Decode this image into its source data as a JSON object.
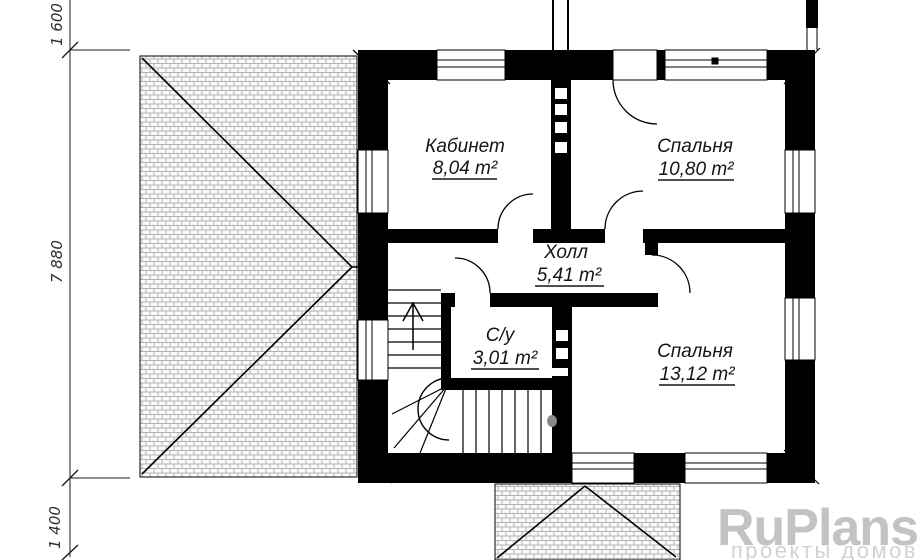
{
  "plan": {
    "rooms": [
      {
        "label": "Кабинет",
        "area": "8,04 m²"
      },
      {
        "label": "Спальня",
        "area": "10,80 m²"
      },
      {
        "label": "Холл",
        "area": "5,41 m²"
      },
      {
        "label": "С/у",
        "area": "3,01 m²"
      },
      {
        "label": "Спальня",
        "area": "13,12 m²"
      }
    ],
    "dimensions": {
      "top": "1 600",
      "middle": "7 880",
      "bottom": "1 400"
    }
  },
  "watermark": {
    "brand": "RuPlans",
    "tagline": "проекты домов",
    "brand_color": "#c3c3c3",
    "tagline_color": "#d2d2d2"
  },
  "colors": {
    "wall": "#000000",
    "hatch_line": "#b3b3b3"
  }
}
